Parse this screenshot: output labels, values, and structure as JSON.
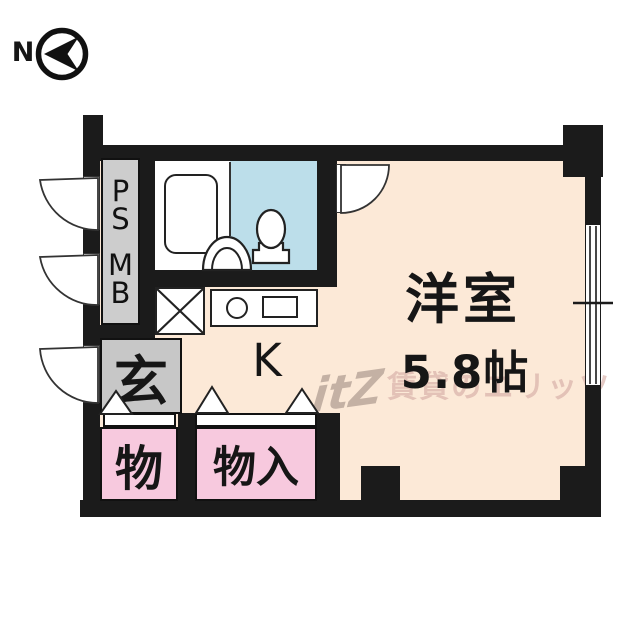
{
  "compass": {
    "label": "N"
  },
  "plan": {
    "utility_column": {
      "letters": [
        "P",
        "S",
        "M",
        "B"
      ]
    },
    "entrance": {
      "label": "玄"
    },
    "kitchen": {
      "label": "K"
    },
    "main_room": {
      "name": "洋室",
      "size": "5.8帖"
    },
    "storage_small": {
      "label": "物"
    },
    "storage_closet": {
      "label": "物入"
    }
  },
  "watermark": {
    "logo": "itZ",
    "text": "賃貸のエリッツ"
  },
  "colors": {
    "wall": "#1b1b1b",
    "floor_peach": "#fce9d7",
    "storage_pink": "#f7c9de",
    "toilet_blue": "#bcdeea",
    "utility_gray": "#cdcdcd",
    "entrance_gray": "#c7c7c7"
  }
}
